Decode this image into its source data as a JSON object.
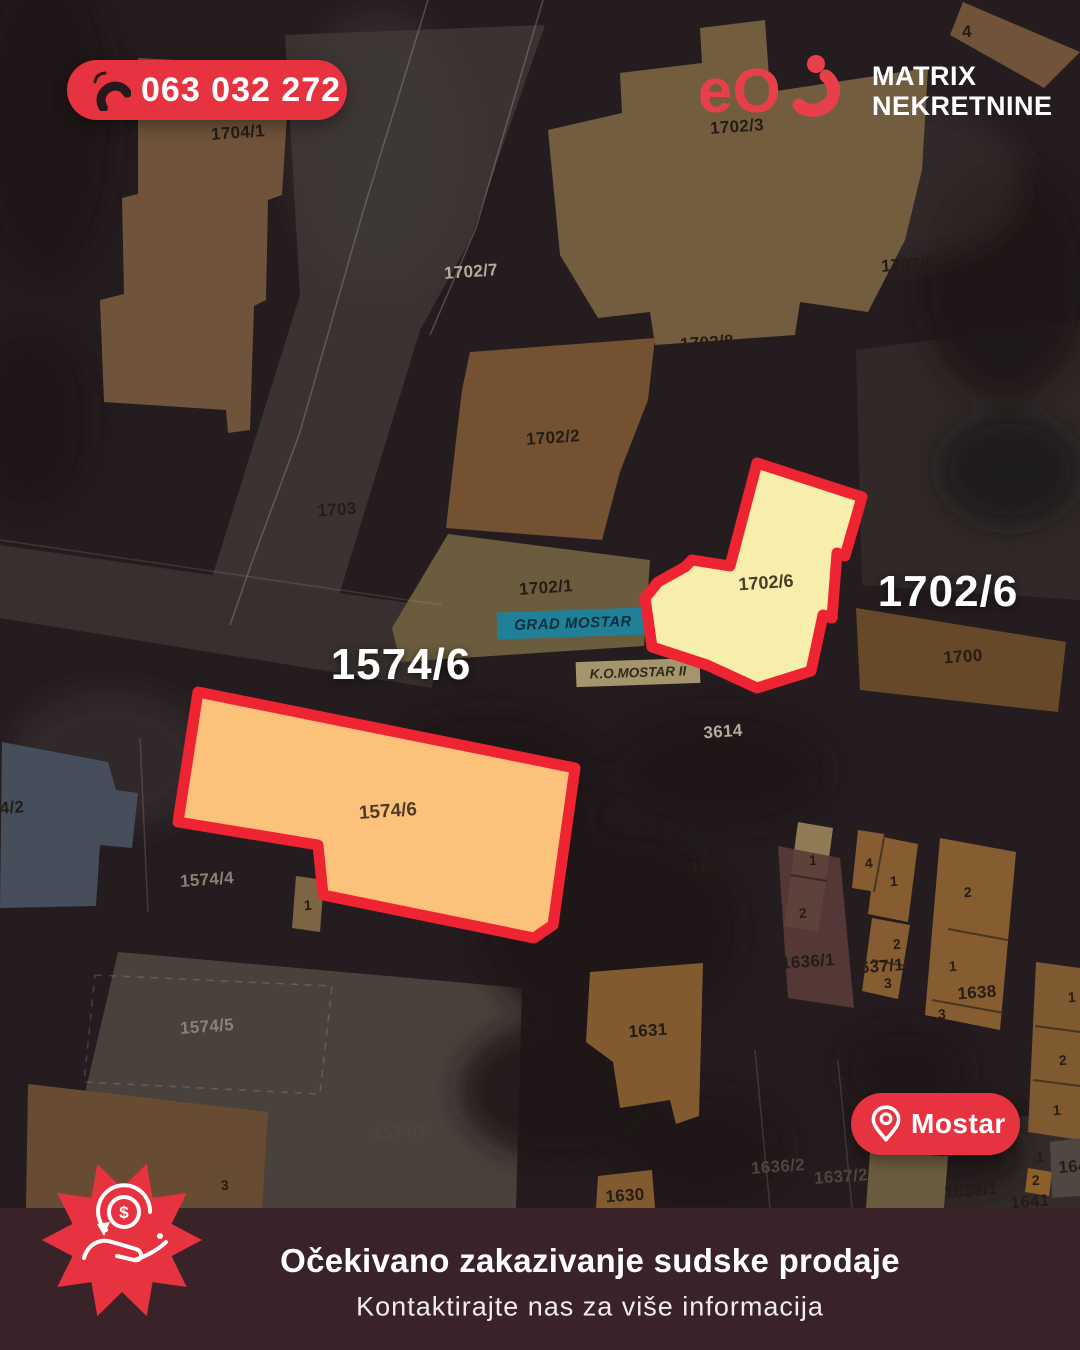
{
  "phone": {
    "number": "063 032 272"
  },
  "logo": {
    "mark": "eO",
    "company_line1": "MATRIX",
    "company_line2": "NEKRETNINE"
  },
  "location_badge": {
    "label": "Mostar"
  },
  "banner": {
    "title": "Očekivano zakazivanje sudske prodaje",
    "subtitle": "Kontaktirajte nas za više informacija"
  },
  "highlights": {
    "parcel_1574_6": {
      "big_label": "1574/6",
      "map_label": "1574/6"
    },
    "parcel_1702_6": {
      "big_label": "1702/6",
      "map_label": "1702/6"
    }
  },
  "map": {
    "municipality_label": "GRAD MOSTAR",
    "cadastral_label": "K.O.MOSTAR II",
    "labels": [
      {
        "text": "1704/1"
      },
      {
        "text": "1702/3"
      },
      {
        "text": "1702/7"
      },
      {
        "text": "1702/5"
      },
      {
        "text": "1702/8"
      },
      {
        "text": "1702/2"
      },
      {
        "text": "1703"
      },
      {
        "text": "1702/1"
      },
      {
        "text": "1700"
      },
      {
        "text": "3614"
      },
      {
        "text": "1574/4"
      },
      {
        "text": "1635"
      },
      {
        "text": "1636/1"
      },
      {
        "text": "1637/1"
      },
      {
        "text": "1638"
      },
      {
        "text": "1574/5"
      },
      {
        "text": "1631"
      },
      {
        "text": "1574/7"
      },
      {
        "text": "1630"
      },
      {
        "text": "1636/2"
      },
      {
        "text": "1637/2"
      },
      {
        "text": "1639/1"
      },
      {
        "text": "1641"
      },
      {
        "text": "4"
      },
      {
        "text": "1"
      },
      {
        "text": "2"
      },
      {
        "text": "4"
      },
      {
        "text": "1"
      },
      {
        "text": "2"
      },
      {
        "text": "2"
      },
      {
        "text": "1"
      },
      {
        "text": "3"
      },
      {
        "text": "3"
      },
      {
        "text": "1"
      },
      {
        "text": "2"
      },
      {
        "text": "1"
      },
      {
        "text": "1"
      },
      {
        "text": "2"
      },
      {
        "text": "164"
      },
      {
        "text": "4/2"
      },
      {
        "text": "3"
      },
      {
        "text": "1"
      }
    ]
  },
  "colors": {
    "accent_red": "#e7333f",
    "outline_red": "#ee2433",
    "highlight_yellow": "#f7eeab",
    "highlight_orange": "#fcc27c",
    "band_background": "#392329",
    "municipality_teal": "#1f8097"
  }
}
